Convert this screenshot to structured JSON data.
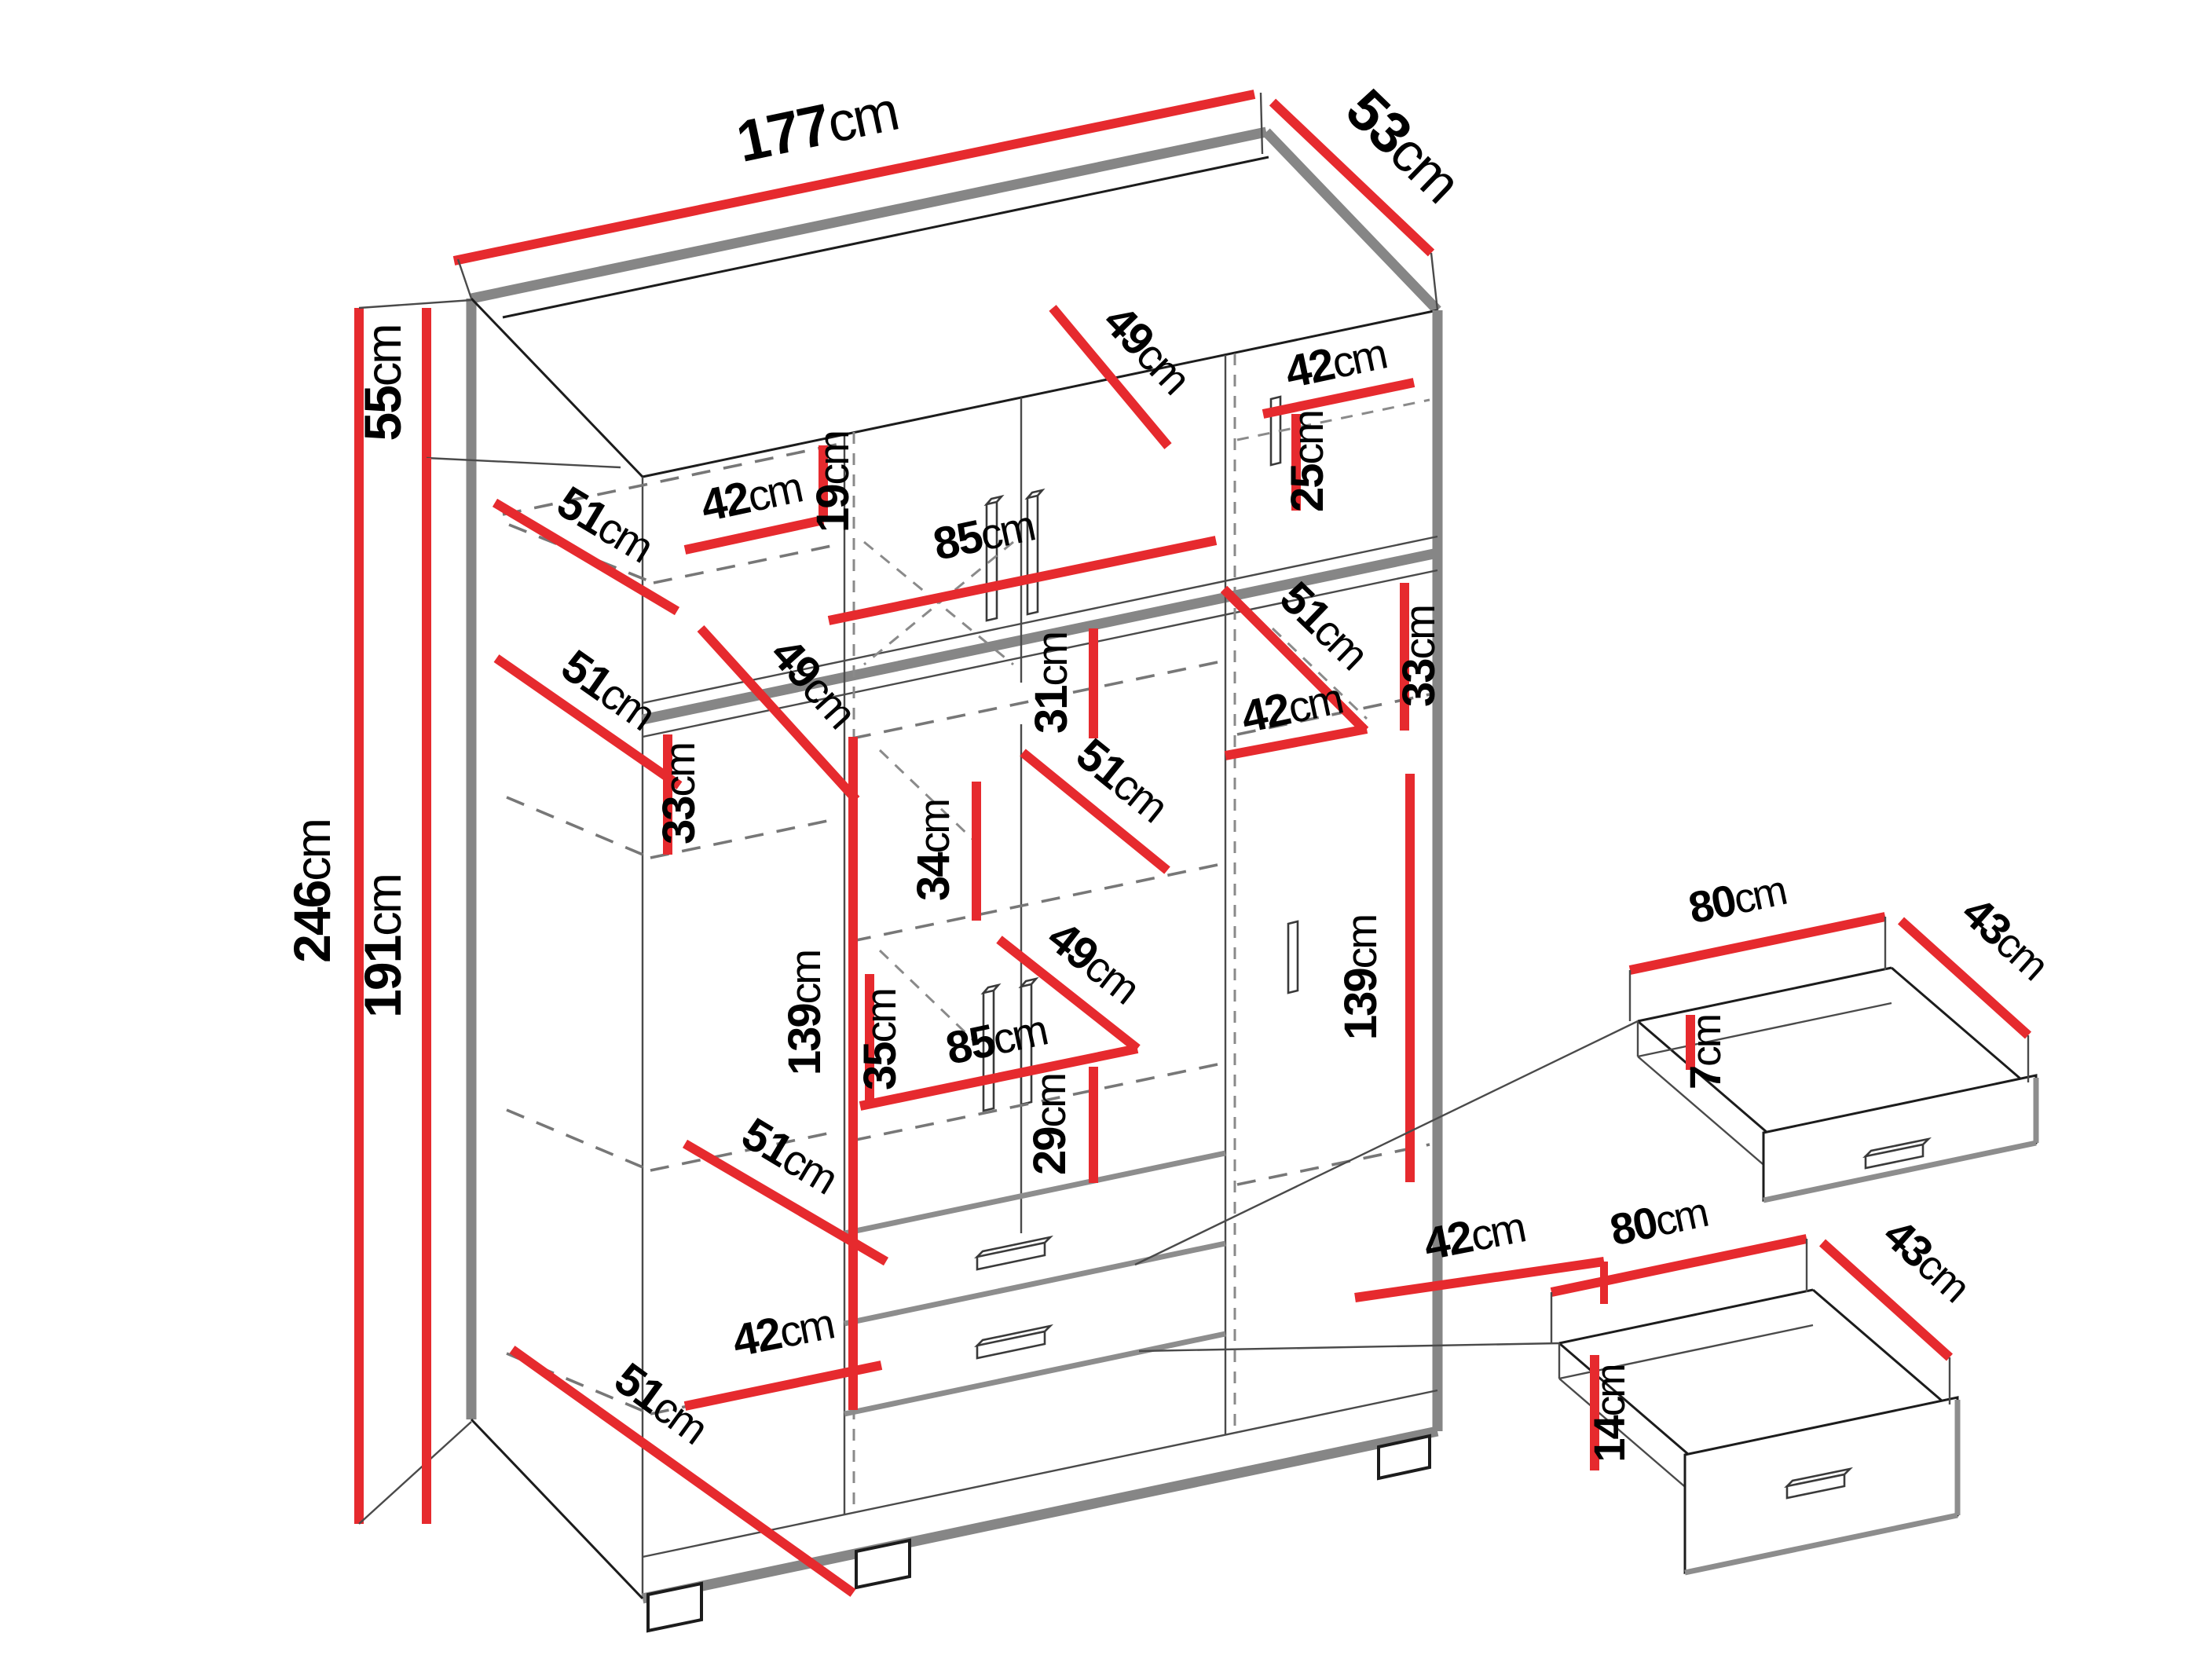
{
  "title": "Wardrobe dimension diagram",
  "unit": "cm",
  "colors": {
    "dimension_line": "#e62a2e",
    "structure": "#868686",
    "label": "#000000",
    "background": "#ffffff"
  },
  "wardrobe": {
    "total_width": "177",
    "total_depth": "53",
    "total_height": "246",
    "top_section_height": "55",
    "bottom_section_height": "191"
  },
  "drawer_details": [
    {
      "width": "80",
      "depth": "43",
      "height": "7",
      "unit": "cm"
    },
    {
      "width": "80",
      "depth": "43",
      "height": "14",
      "unit": "cm"
    }
  ],
  "dims": {
    "d177": {
      "v": "177",
      "u": "cm"
    },
    "d53": {
      "v": "53",
      "u": "cm"
    },
    "d246": {
      "v": "246",
      "u": "cm"
    },
    "d55": {
      "v": "55",
      "u": "cm"
    },
    "d191": {
      "v": "191",
      "u": "cm"
    },
    "d42a": {
      "v": "42",
      "u": "cm"
    },
    "d19": {
      "v": "19",
      "u": "cm"
    },
    "d85a": {
      "v": "85",
      "u": "cm"
    },
    "d49a": {
      "v": "49",
      "u": "cm"
    },
    "d42b": {
      "v": "42",
      "u": "cm"
    },
    "d25": {
      "v": "25",
      "u": "cm"
    },
    "d51a": {
      "v": "51",
      "u": "cm"
    },
    "d51b": {
      "v": "51",
      "u": "cm"
    },
    "d49b": {
      "v": "49",
      "u": "cm"
    },
    "d33a": {
      "v": "33",
      "u": "cm"
    },
    "d31": {
      "v": "31",
      "u": "cm"
    },
    "d51c": {
      "v": "51",
      "u": "cm"
    },
    "d42c": {
      "v": "42",
      "u": "cm"
    },
    "d33b": {
      "v": "33",
      "u": "cm"
    },
    "d51d": {
      "v": "51",
      "u": "cm"
    },
    "d34": {
      "v": "34",
      "u": "cm"
    },
    "d35": {
      "v": "35",
      "u": "cm"
    },
    "d85b": {
      "v": "85",
      "u": "cm"
    },
    "d49c": {
      "v": "49",
      "u": "cm"
    },
    "d29": {
      "v": "29",
      "u": "cm"
    },
    "d139a": {
      "v": "139",
      "u": "cm"
    },
    "d139b": {
      "v": "139",
      "u": "cm"
    },
    "d42d": {
      "v": "42",
      "u": "cm"
    },
    "d42e": {
      "v": "42",
      "u": "cm"
    },
    "d51e": {
      "v": "51",
      "u": "cm"
    },
    "d51f": {
      "v": "51",
      "u": "cm"
    },
    "d80a": {
      "v": "80",
      "u": "cm"
    },
    "d43a": {
      "v": "43",
      "u": "cm"
    },
    "d7": {
      "v": "7",
      "u": "cm"
    },
    "d80b": {
      "v": "80",
      "u": "cm"
    },
    "d43b": {
      "v": "43",
      "u": "cm"
    },
    "d14": {
      "v": "14",
      "u": "cm"
    }
  }
}
